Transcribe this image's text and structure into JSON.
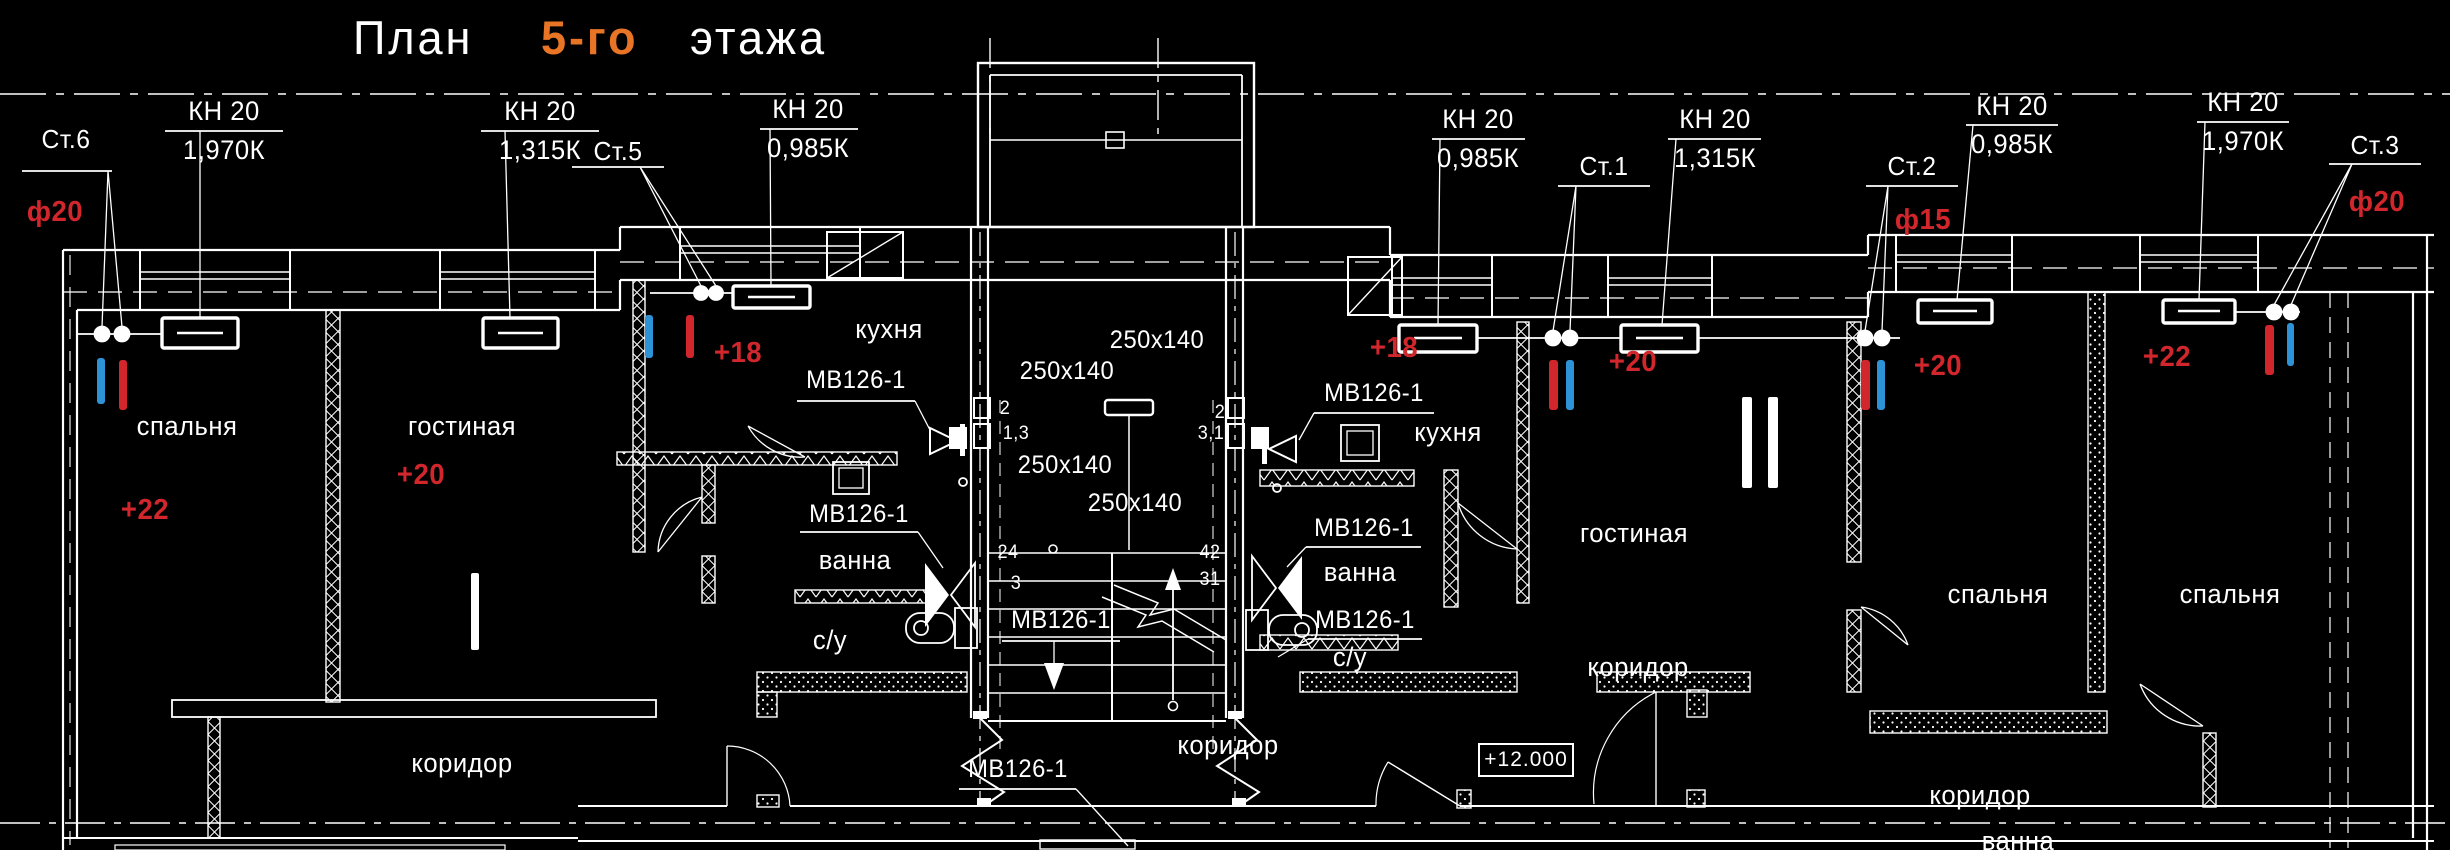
{
  "title": {
    "word1": "План",
    "word2": "5-го",
    "word3": "этажа"
  },
  "colors": {
    "background": "#000000",
    "line": "#ffffff",
    "red": "#d1262c",
    "blue": "#2e93d6",
    "orange": "#e87425"
  },
  "elevation": {
    "label": "+12.000"
  },
  "labels": [
    {
      "kind": "kn-tag",
      "text": "КН 20",
      "x": 224,
      "y": 98,
      "s": 27,
      "c": "white"
    },
    {
      "kind": "kn-load",
      "text": "1,970К",
      "x": 224,
      "y": 137,
      "s": 27,
      "c": "white"
    },
    {
      "kind": "kn-tag",
      "text": "КН 20",
      "x": 540,
      "y": 98,
      "s": 27,
      "c": "white"
    },
    {
      "kind": "kn-load",
      "text": "1,315К",
      "x": 540,
      "y": 137,
      "s": 27,
      "c": "white"
    },
    {
      "kind": "kn-tag",
      "text": "КН 20",
      "x": 808,
      "y": 96,
      "s": 27,
      "c": "white"
    },
    {
      "kind": "kn-load",
      "text": "0,985К",
      "x": 808,
      "y": 135,
      "s": 27,
      "c": "white"
    },
    {
      "kind": "kn-tag",
      "text": "КН 20",
      "x": 1478,
      "y": 106,
      "s": 27,
      "c": "white"
    },
    {
      "kind": "kn-load",
      "text": "0,985К",
      "x": 1478,
      "y": 145,
      "s": 27,
      "c": "white"
    },
    {
      "kind": "kn-tag",
      "text": "КН 20",
      "x": 1715,
      "y": 106,
      "s": 27,
      "c": "white"
    },
    {
      "kind": "kn-load",
      "text": "1,315К",
      "x": 1715,
      "y": 145,
      "s": 27,
      "c": "white"
    },
    {
      "kind": "kn-tag",
      "text": "КН 20",
      "x": 2012,
      "y": 93,
      "s": 27,
      "c": "white"
    },
    {
      "kind": "kn-load",
      "text": "0,985К",
      "x": 2012,
      "y": 131,
      "s": 27,
      "c": "white"
    },
    {
      "kind": "kn-tag",
      "text": "КН 20",
      "x": 2243,
      "y": 89,
      "s": 27,
      "c": "white"
    },
    {
      "kind": "kn-load",
      "text": "1,970К",
      "x": 2243,
      "y": 128,
      "s": 27,
      "c": "white"
    },
    {
      "kind": "riser-id",
      "text": "Ст.6",
      "x": 66,
      "y": 126,
      "s": 26,
      "c": "white"
    },
    {
      "kind": "riser-id",
      "text": "Ст.5",
      "x": 618,
      "y": 138,
      "s": 26,
      "c": "white"
    },
    {
      "kind": "riser-id",
      "text": "Ст.1",
      "x": 1604,
      "y": 153,
      "s": 26,
      "c": "white"
    },
    {
      "kind": "riser-id",
      "text": "Ст.2",
      "x": 1912,
      "y": 153,
      "s": 26,
      "c": "white"
    },
    {
      "kind": "riser-id",
      "text": "Ст.3",
      "x": 2375,
      "y": 132,
      "s": 26,
      "c": "white"
    },
    {
      "kind": "pipe-diameter",
      "text": "ф20",
      "x": 55,
      "y": 198,
      "s": 29,
      "c": "red"
    },
    {
      "kind": "pipe-diameter",
      "text": "ф15",
      "x": 1923,
      "y": 206,
      "s": 29,
      "c": "red"
    },
    {
      "kind": "pipe-diameter",
      "text": "ф20",
      "x": 2377,
      "y": 188,
      "s": 29,
      "c": "red"
    },
    {
      "kind": "temperature",
      "text": "+22",
      "x": 145,
      "y": 496,
      "s": 29,
      "c": "red"
    },
    {
      "kind": "temperature",
      "text": "+20",
      "x": 421,
      "y": 461,
      "s": 29,
      "c": "red"
    },
    {
      "kind": "temperature",
      "text": "+18",
      "x": 738,
      "y": 339,
      "s": 29,
      "c": "red"
    },
    {
      "kind": "temperature",
      "text": "+18",
      "x": 1394,
      "y": 334,
      "s": 29,
      "c": "red"
    },
    {
      "kind": "temperature",
      "text": "+20",
      "x": 1633,
      "y": 348,
      "s": 29,
      "c": "red"
    },
    {
      "kind": "temperature",
      "text": "+20",
      "x": 1938,
      "y": 352,
      "s": 29,
      "c": "red"
    },
    {
      "kind": "temperature",
      "text": "+22",
      "x": 2167,
      "y": 343,
      "s": 29,
      "c": "red"
    },
    {
      "kind": "room",
      "text": "спальня",
      "x": 187,
      "y": 413,
      "s": 27,
      "c": "white"
    },
    {
      "kind": "room",
      "text": "гостиная",
      "x": 462,
      "y": 413,
      "s": 27,
      "c": "white"
    },
    {
      "kind": "room",
      "text": "кухня",
      "x": 889,
      "y": 316,
      "s": 27,
      "c": "white"
    },
    {
      "kind": "room",
      "text": "ванна",
      "x": 855,
      "y": 547,
      "s": 27,
      "c": "white"
    },
    {
      "kind": "room",
      "text": "с/у",
      "x": 830,
      "y": 627,
      "s": 27,
      "c": "white"
    },
    {
      "kind": "room",
      "text": "коридор",
      "x": 462,
      "y": 750,
      "s": 27,
      "c": "white"
    },
    {
      "kind": "room",
      "text": "кухня",
      "x": 1448,
      "y": 419,
      "s": 27,
      "c": "white"
    },
    {
      "kind": "room",
      "text": "гостиная",
      "x": 1634,
      "y": 520,
      "s": 27,
      "c": "white"
    },
    {
      "kind": "room",
      "text": "ванна",
      "x": 1360,
      "y": 559,
      "s": 27,
      "c": "white"
    },
    {
      "kind": "room",
      "text": "с/у",
      "x": 1350,
      "y": 644,
      "s": 27,
      "c": "white"
    },
    {
      "kind": "room",
      "text": "коридор",
      "x": 1638,
      "y": 654,
      "s": 27,
      "c": "white"
    },
    {
      "kind": "room",
      "text": "коридор",
      "x": 1228,
      "y": 732,
      "s": 27,
      "c": "white"
    },
    {
      "kind": "room",
      "text": "коридор",
      "x": 1980,
      "y": 782,
      "s": 27,
      "c": "white"
    },
    {
      "kind": "room",
      "text": "спальня",
      "x": 1998,
      "y": 581,
      "s": 27,
      "c": "white"
    },
    {
      "kind": "room",
      "text": "спальня",
      "x": 2230,
      "y": 581,
      "s": 27,
      "c": "white"
    },
    {
      "kind": "room",
      "text": "ванна",
      "x": 2018,
      "y": 828,
      "s": 27,
      "c": "white"
    },
    {
      "kind": "vent-unit",
      "text": "МВ126-1",
      "x": 856,
      "y": 368,
      "s": 25,
      "c": "white"
    },
    {
      "kind": "vent-unit",
      "text": "МВ126-1",
      "x": 859,
      "y": 502,
      "s": 25,
      "c": "white"
    },
    {
      "kind": "vent-unit",
      "text": "МВ126-1",
      "x": 1061,
      "y": 608,
      "s": 25,
      "c": "white"
    },
    {
      "kind": "vent-unit",
      "text": "МВ126-1",
      "x": 1018,
      "y": 757,
      "s": 25,
      "c": "white"
    },
    {
      "kind": "vent-unit",
      "text": "МВ126-1",
      "x": 1374,
      "y": 381,
      "s": 25,
      "c": "white"
    },
    {
      "kind": "vent-unit",
      "text": "МВ126-1",
      "x": 1364,
      "y": 516,
      "s": 25,
      "c": "white"
    },
    {
      "kind": "vent-unit",
      "text": "МВ126-1",
      "x": 1365,
      "y": 608,
      "s": 25,
      "c": "white"
    },
    {
      "kind": "duct-size",
      "text": "250x140",
      "x": 1157,
      "y": 328,
      "s": 25,
      "c": "white"
    },
    {
      "kind": "duct-size",
      "text": "250x140",
      "x": 1067,
      "y": 359,
      "s": 25,
      "c": "white"
    },
    {
      "kind": "duct-size",
      "text": "250x140",
      "x": 1065,
      "y": 453,
      "s": 25,
      "c": "white"
    },
    {
      "kind": "duct-size",
      "text": "250x140",
      "x": 1135,
      "y": 491,
      "s": 25,
      "c": "white"
    },
    {
      "kind": "shaft-number",
      "text": "2",
      "x": 1005,
      "y": 399,
      "s": 19,
      "c": "white"
    },
    {
      "kind": "shaft-number",
      "text": "1,3",
      "x": 1016,
      "y": 424,
      "s": 19,
      "c": "white"
    },
    {
      "kind": "shaft-number",
      "text": "2",
      "x": 1220,
      "y": 403,
      "s": 19,
      "c": "white"
    },
    {
      "kind": "shaft-number",
      "text": "3,1",
      "x": 1211,
      "y": 424,
      "s": 19,
      "c": "white"
    },
    {
      "kind": "stair-number",
      "text": "24",
      "x": 1008,
      "y": 543,
      "s": 19,
      "c": "white"
    },
    {
      "kind": "stair-number",
      "text": "3",
      "x": 1016,
      "y": 574,
      "s": 19,
      "c": "white"
    },
    {
      "kind": "stair-number",
      "text": "42",
      "x": 1210,
      "y": 543,
      "s": 19,
      "c": "white"
    },
    {
      "kind": "stair-number",
      "text": "31",
      "x": 1210,
      "y": 570,
      "s": 19,
      "c": "white"
    }
  ],
  "riser_bars": [
    {
      "x": 97,
      "y": 358,
      "w": 8,
      "h": 46,
      "color": "blue"
    },
    {
      "x": 119,
      "y": 360,
      "w": 8,
      "h": 50,
      "color": "red"
    },
    {
      "x": 645,
      "y": 315,
      "w": 8,
      "h": 43,
      "color": "blue"
    },
    {
      "x": 686,
      "y": 315,
      "w": 8,
      "h": 43,
      "color": "red"
    },
    {
      "x": 1549,
      "y": 360,
      "w": 9,
      "h": 50,
      "color": "red"
    },
    {
      "x": 1566,
      "y": 360,
      "w": 8,
      "h": 50,
      "color": "blue"
    },
    {
      "x": 1861,
      "y": 360,
      "w": 9,
      "h": 50,
      "color": "red"
    },
    {
      "x": 1877,
      "y": 360,
      "w": 8,
      "h": 50,
      "color": "blue"
    },
    {
      "x": 2265,
      "y": 325,
      "w": 9,
      "h": 50,
      "color": "red"
    },
    {
      "x": 2287,
      "y": 323,
      "w": 7,
      "h": 43,
      "color": "blue"
    }
  ],
  "apartment_marks": [
    {
      "numeral": "I",
      "bars": [
        [
          471,
          573,
          8,
          77
        ]
      ]
    },
    {
      "numeral": "II",
      "bars": [
        [
          1742,
          397,
          10,
          91
        ],
        [
          1768,
          397,
          10,
          91
        ]
      ]
    }
  ]
}
